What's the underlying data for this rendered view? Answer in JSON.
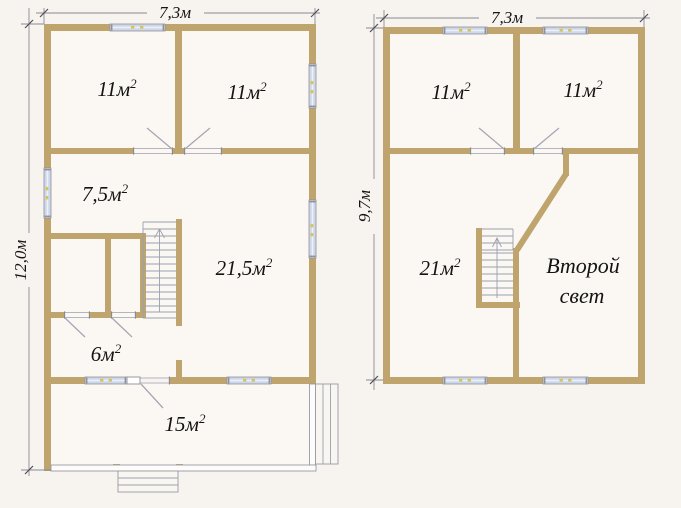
{
  "figure": {
    "kind": "house-floor-plans",
    "colors": {
      "background": "#f7f3ee",
      "wall": "#bfa46d",
      "window": "#cdd8ea",
      "window_mark": "#d8c450"
    },
    "floor1": {
      "width_label": "7,3м",
      "height_label": "12,0м",
      "rooms": [
        {
          "area": "11м",
          "sup": "2"
        },
        {
          "area": "11м",
          "sup": "2"
        },
        {
          "area": "7,5м",
          "sup": "2"
        },
        {
          "area": "21,5м",
          "sup": "2"
        },
        {
          "area": "6м",
          "sup": "2"
        },
        {
          "area": "15м",
          "sup": "2"
        }
      ]
    },
    "floor2": {
      "width_label": "7,3м",
      "height_label": "9,7м",
      "rooms": [
        {
          "area": "11м",
          "sup": "2"
        },
        {
          "area": "11м",
          "sup": "2"
        },
        {
          "area": "21м",
          "sup": "2"
        }
      ],
      "void_label_line1": "Второй",
      "void_label_line2": "свет"
    }
  }
}
